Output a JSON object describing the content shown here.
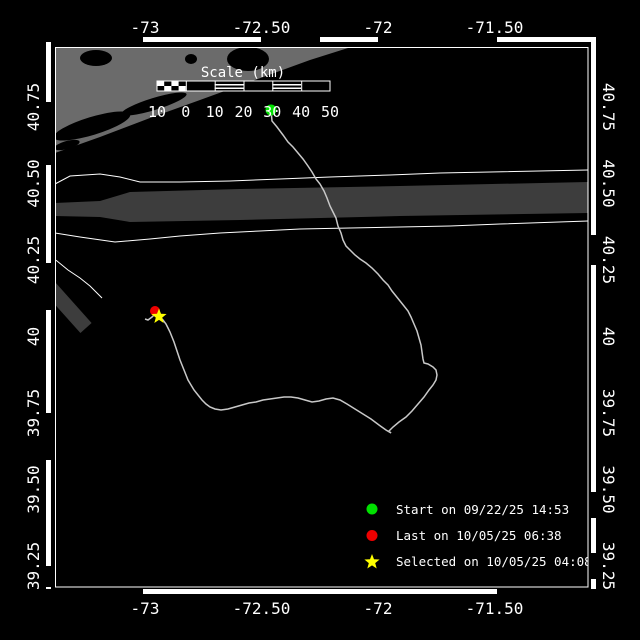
{
  "axes": {
    "top": [
      "-73",
      "-72.50",
      "-72",
      "-71.50"
    ],
    "bottom": [
      "-73",
      "-72.50",
      "-72",
      "-71.50"
    ],
    "left": [
      "40.75",
      "40.50",
      "40.25",
      "40",
      "39.75",
      "39.50",
      "39.25"
    ],
    "right": [
      "40.75",
      "40.50",
      "40.25",
      "40",
      "39.75",
      "39.50",
      "39.25"
    ]
  },
  "scale_bar": {
    "title": "Scale (km)",
    "labels": [
      "10",
      "0",
      "10",
      "20",
      "30",
      "40",
      "50"
    ]
  },
  "legend": {
    "start": {
      "label": "Start on 09/22/25 14:53",
      "color": "#00e000"
    },
    "last": {
      "label": "Last on 10/05/25 06:38",
      "color": "#ee0000"
    },
    "selected": {
      "label": "Selected on 10/05/25 04:08",
      "color": "#ffff00"
    }
  },
  "colors": {
    "background": "#000000",
    "land": "#6b6b6b",
    "traffic_lane": "#3d3d3d",
    "track": "#c8c8c8",
    "frame": "#ffffff"
  },
  "geometry": {
    "coast": [
      [
        55,
        48
      ],
      [
        348,
        48
      ],
      [
        310,
        60
      ],
      [
        255,
        80
      ],
      [
        200,
        100
      ],
      [
        150,
        118
      ],
      [
        100,
        137
      ],
      [
        55,
        153
      ]
    ],
    "lane_band": [
      [
        55,
        203
      ],
      [
        100,
        201
      ],
      [
        130,
        192
      ],
      [
        240,
        189
      ],
      [
        400,
        186
      ],
      [
        588,
        182
      ],
      [
        588,
        213
      ],
      [
        400,
        216
      ],
      [
        240,
        220
      ],
      [
        130,
        222
      ],
      [
        100,
        217
      ],
      [
        55,
        216
      ]
    ],
    "lane_upper": [
      [
        55,
        184
      ],
      [
        70,
        176
      ],
      [
        100,
        174
      ],
      [
        120,
        177
      ],
      [
        140,
        182
      ],
      [
        180,
        182
      ],
      [
        230,
        181
      ],
      [
        280,
        179
      ],
      [
        330,
        177
      ],
      [
        390,
        175
      ],
      [
        440,
        173
      ],
      [
        588,
        170
      ]
    ],
    "lane_lower": [
      [
        55,
        233
      ],
      [
        80,
        237
      ],
      [
        115,
        242
      ],
      [
        150,
        239
      ],
      [
        180,
        236
      ],
      [
        220,
        233
      ],
      [
        260,
        231
      ],
      [
        300,
        229
      ],
      [
        350,
        228
      ],
      [
        400,
        227
      ],
      [
        450,
        226
      ],
      [
        500,
        224
      ],
      [
        588,
        221
      ]
    ],
    "lane_spur": [
      [
        46,
        254
      ],
      [
        57,
        261
      ],
      [
        68,
        270
      ],
      [
        80,
        278
      ],
      [
        90,
        286
      ],
      [
        97,
        293
      ],
      [
        102,
        298
      ]
    ],
    "track": [
      [
        271,
        110
      ],
      [
        272,
        121
      ],
      [
        277,
        127
      ],
      [
        283,
        135
      ],
      [
        288,
        142
      ],
      [
        293,
        147
      ],
      [
        298,
        153
      ],
      [
        303,
        159
      ],
      [
        308,
        166
      ],
      [
        312,
        172
      ],
      [
        316,
        179
      ],
      [
        320,
        184
      ],
      [
        324,
        191
      ],
      [
        327,
        198
      ],
      [
        330,
        206
      ],
      [
        333,
        212
      ],
      [
        336,
        218
      ],
      [
        338,
        226
      ],
      [
        341,
        233
      ],
      [
        343,
        240
      ],
      [
        346,
        246
      ],
      [
        350,
        250
      ],
      [
        355,
        255
      ],
      [
        360,
        259
      ],
      [
        366,
        263
      ],
      [
        372,
        268
      ],
      [
        378,
        274
      ],
      [
        383,
        280
      ],
      [
        388,
        285
      ],
      [
        392,
        291
      ],
      [
        396,
        296
      ],
      [
        400,
        301
      ],
      [
        404,
        306
      ],
      [
        408,
        311
      ],
      [
        411,
        317
      ],
      [
        414,
        324
      ],
      [
        417,
        331
      ],
      [
        419,
        338
      ],
      [
        421,
        345
      ],
      [
        422,
        352
      ],
      [
        423,
        359
      ],
      [
        424,
        363
      ],
      [
        428,
        364
      ],
      [
        433,
        367
      ],
      [
        436,
        370
      ],
      [
        437,
        375
      ],
      [
        436,
        380
      ],
      [
        433,
        385
      ],
      [
        429,
        390
      ],
      [
        424,
        397
      ],
      [
        418,
        404
      ],
      [
        412,
        411
      ],
      [
        406,
        417
      ],
      [
        399,
        422
      ],
      [
        393,
        427
      ],
      [
        389,
        431
      ],
      [
        391,
        433
      ],
      [
        386,
        430
      ],
      [
        379,
        425
      ],
      [
        371,
        419
      ],
      [
        363,
        414
      ],
      [
        355,
        409
      ],
      [
        347,
        404
      ],
      [
        340,
        400
      ],
      [
        333,
        398
      ],
      [
        326,
        399
      ],
      [
        319,
        401
      ],
      [
        312,
        402
      ],
      [
        305,
        400
      ],
      [
        298,
        398
      ],
      [
        291,
        397
      ],
      [
        284,
        397
      ],
      [
        277,
        398
      ],
      [
        270,
        399
      ],
      [
        263,
        400
      ],
      [
        256,
        402
      ],
      [
        249,
        403
      ],
      [
        242,
        405
      ],
      [
        235,
        407
      ],
      [
        228,
        409
      ],
      [
        221,
        410
      ],
      [
        215,
        409
      ],
      [
        210,
        407
      ],
      [
        206,
        404
      ],
      [
        202,
        400
      ],
      [
        198,
        395
      ],
      [
        194,
        390
      ],
      [
        191,
        385
      ],
      [
        188,
        380
      ],
      [
        186,
        375
      ],
      [
        184,
        370
      ],
      [
        182,
        365
      ],
      [
        180,
        360
      ],
      [
        178,
        354
      ],
      [
        176,
        348
      ],
      [
        174,
        342
      ],
      [
        172,
        337
      ],
      [
        170,
        332
      ],
      [
        168,
        328
      ],
      [
        166,
        324
      ],
      [
        163,
        320
      ],
      [
        160,
        317
      ],
      [
        156,
        313
      ],
      [
        152,
        317
      ],
      [
        148,
        320
      ],
      [
        145,
        319
      ]
    ],
    "markers": {
      "start": [
        271,
        110
      ],
      "last": [
        155,
        311
      ],
      "selected": [
        159,
        316
      ]
    }
  }
}
